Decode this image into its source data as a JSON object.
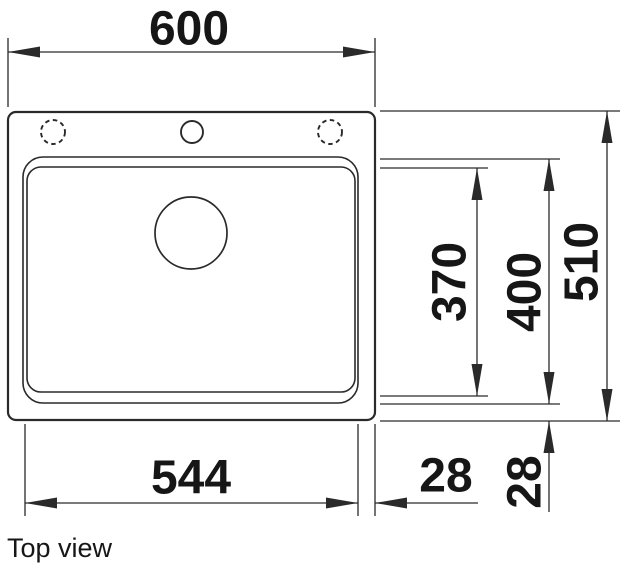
{
  "title": "Top view",
  "drawing_type": "sink-top-view-technical-drawing",
  "colors": {
    "line": "#2a2a2a",
    "text": "#161616",
    "background": "#ffffff"
  },
  "dims": {
    "overall_width": "600",
    "overall_depth": "510",
    "cutout_width": "544",
    "bowl_inner_depth": "370",
    "bowl_outer_depth": "400",
    "offset_right": "28",
    "offset_bottom": "28"
  }
}
